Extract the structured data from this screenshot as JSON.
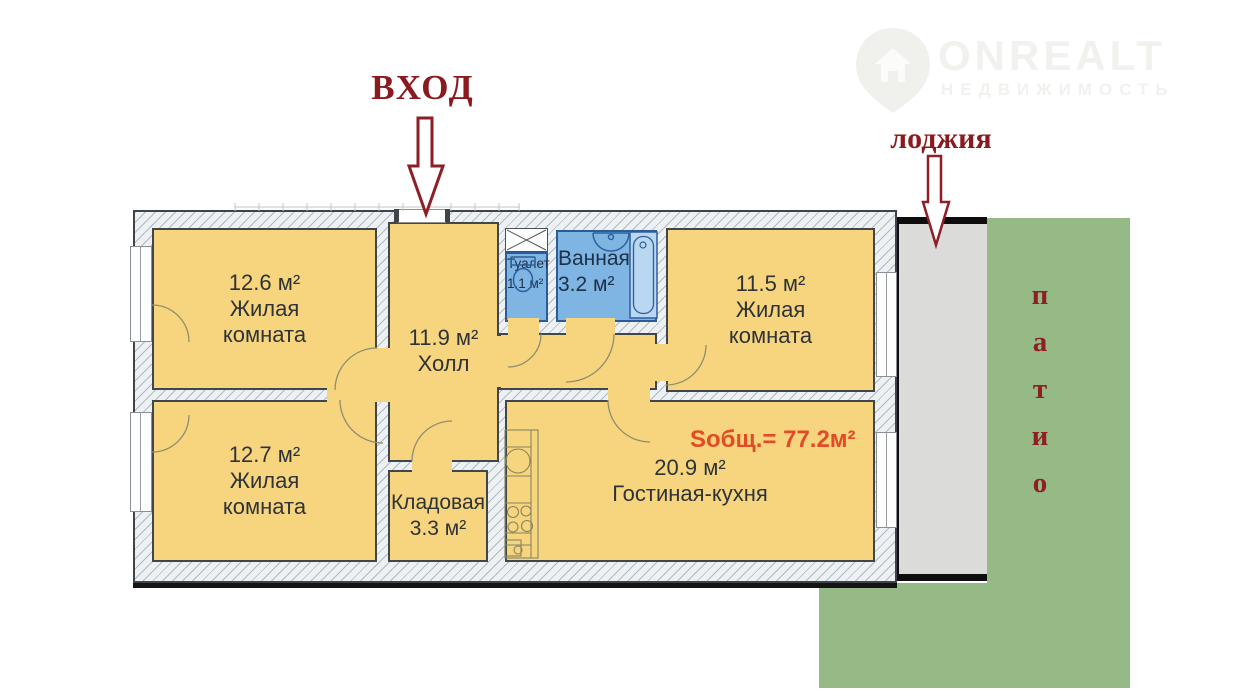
{
  "logo": {
    "brand": "ONREALT",
    "subtitle": "НЕДВИЖИМОСТЬ"
  },
  "labels": {
    "entrance": "ВХОД",
    "loggia": "лоджия",
    "patio_letters": [
      "п",
      "а",
      "т",
      "и",
      "о"
    ],
    "total_area": "Sобщ.= 77.2м²"
  },
  "rooms": {
    "living_room_1": {
      "area": "12.6 м²",
      "name_line1": "Жилая",
      "name_line2": "комната"
    },
    "hall": {
      "area": "11.9 м²",
      "name": "Холл"
    },
    "toilet": {
      "name": "Туалет",
      "area": "1.1 м²"
    },
    "bathroom": {
      "name": "Ванная",
      "area": "3.2 м²"
    },
    "living_room_2": {
      "area": "11.5 м²",
      "name_line1": "Жилая",
      "name_line2": "комната"
    },
    "living_room_3": {
      "area": "12.7 м²",
      "name_line1": "Жилая",
      "name_line2": "комната"
    },
    "storage": {
      "name": "Кладовая",
      "area": "3.3 м²"
    },
    "kitchen_living": {
      "area": "20.9 м²",
      "name": "Гостиная-кухня"
    }
  },
  "colors": {
    "room_fill": "#f7d57e",
    "wet_room_fill": "#7fb5e3",
    "loggia_fill": "#dbdbd9",
    "patio_fill": "#95ba85",
    "annotation_text": "#8b1a1f",
    "total_area_text": "#e34b27"
  }
}
